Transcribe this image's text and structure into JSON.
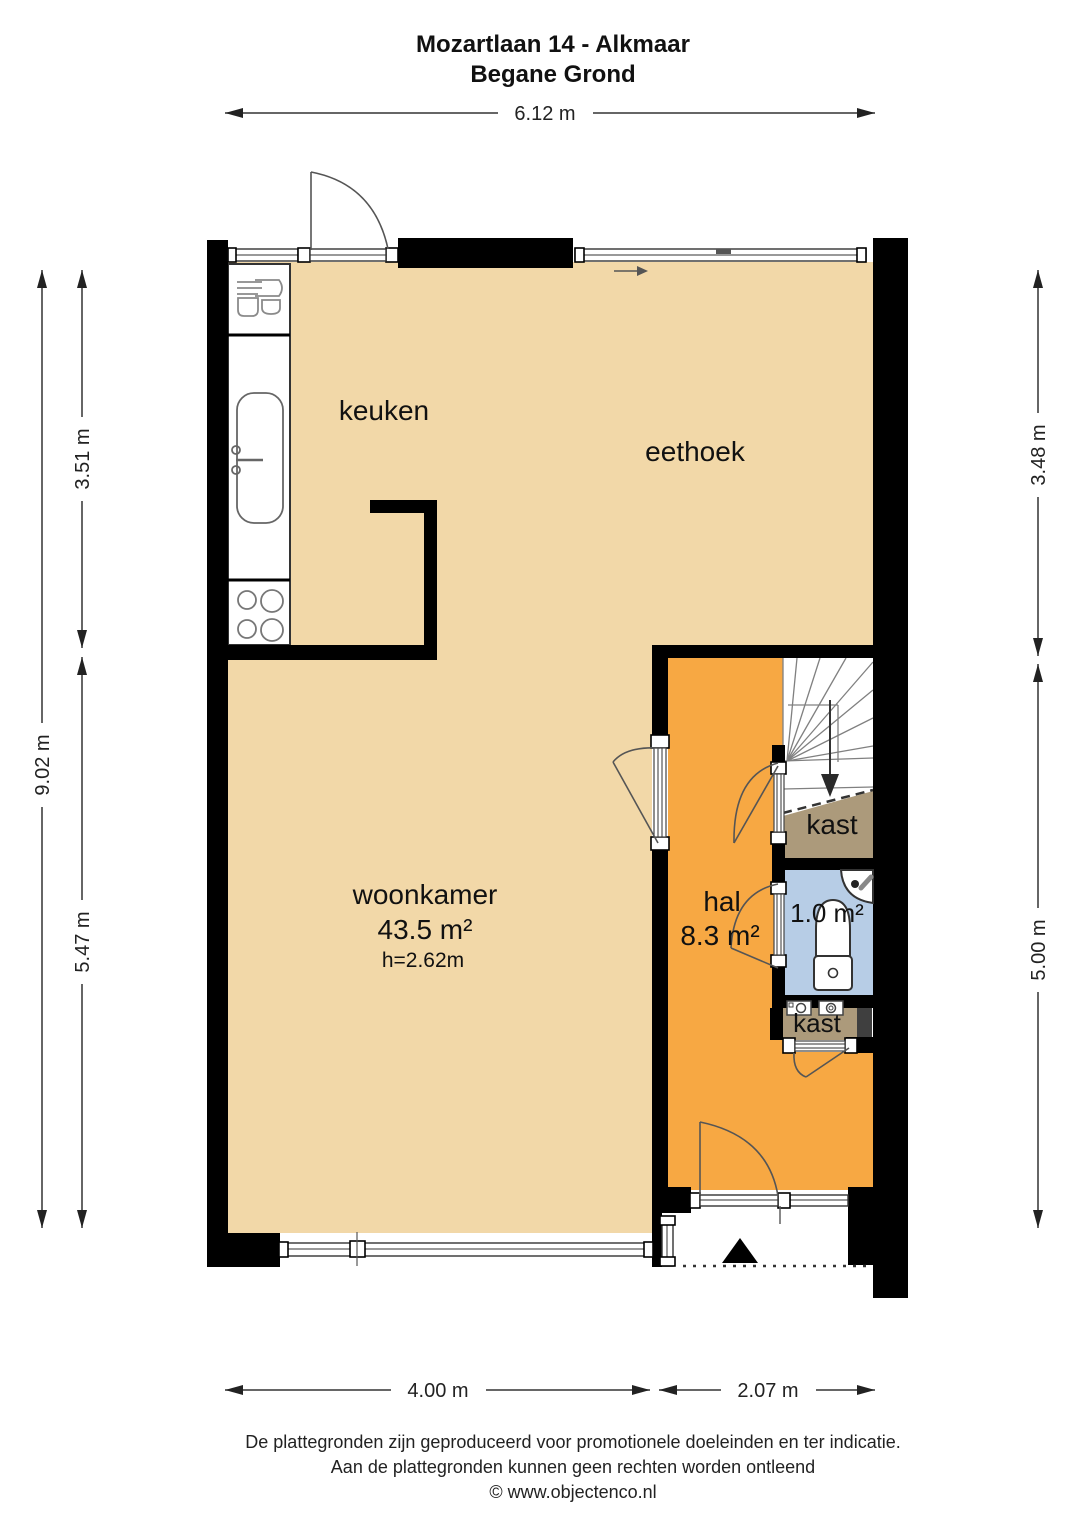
{
  "title": {
    "line1": "Mozartlaan 14 - Alkmaar",
    "line2": "Begane Grond"
  },
  "rooms": {
    "keuken": {
      "label": "keuken"
    },
    "eethoek": {
      "label": "eethoek"
    },
    "woonkamer": {
      "label": "woonkamer",
      "area": "43.5 m²",
      "ceiling_height": "h=2.62m"
    },
    "hal": {
      "label": "hal",
      "area": "8.3 m²"
    },
    "toilet": {
      "area": "1.0 m²"
    },
    "kast_understairs": {
      "label": "kast"
    },
    "kast_utility": {
      "label": "kast"
    }
  },
  "dimensions": {
    "top_width": "6.12 m",
    "left_total": "9.02 m",
    "left_upper": "3.51 m",
    "left_lower": "5.47 m",
    "right_upper": "3.48 m",
    "right_lower": "5.00 m",
    "bottom_left": "4.00 m",
    "bottom_right": "2.07 m"
  },
  "footer": {
    "line1": "De plattegronden zijn geproduceerd voor promotionele doeleinden en ter indicatie.",
    "line2": "Aan de plattegronden kunnen geen rechten worden ontleend",
    "line3": "© www.objectenco.nl"
  },
  "colors": {
    "floor_living": "#F2D8A8",
    "floor_hall": "#F7A843",
    "floor_toilet": "#B7CDE6",
    "floor_closet": "#AC9A7B",
    "wall": "#000000",
    "shaft": "#3F3F3F"
  }
}
